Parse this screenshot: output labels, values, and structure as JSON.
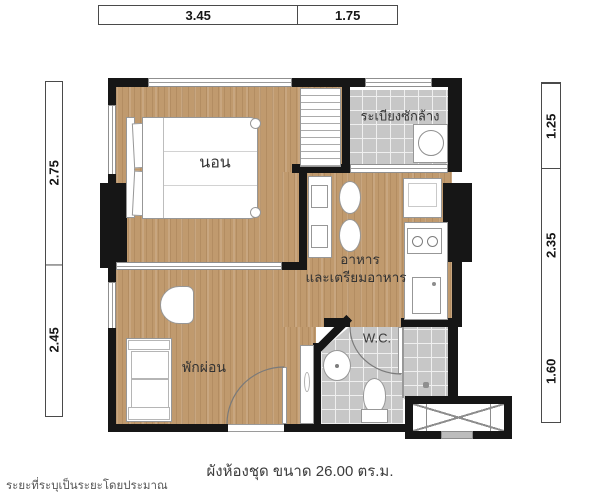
{
  "plan": {
    "rooms": {
      "bedroom": {
        "label": "นอน"
      },
      "balcony": {
        "label": "ระเบียงซักล้าง"
      },
      "kitchen": {
        "label_line1": "อาหาร",
        "label_line2": "และเตรียมอาหาร"
      },
      "living": {
        "label": "พักผ่อน"
      },
      "bathroom": {
        "label": "W.C."
      }
    },
    "dimensions_m": {
      "top": [
        "3.45",
        "1.75"
      ],
      "left": [
        "2.75",
        "2.45"
      ],
      "right": [
        "1.25",
        "2.35",
        "1.60"
      ]
    },
    "caption": "ผังห้องชุด ขนาด 26.00 ตร.ม.",
    "area_sqm": "26.00",
    "footnote": "ระยะที่ระบุเป็นระยะโดยประมาณ",
    "colors": {
      "wood_floor": "#c09a6e",
      "tile_floor": "#c7c7c7",
      "wall": "#161616",
      "background": "#ffffff"
    }
  }
}
